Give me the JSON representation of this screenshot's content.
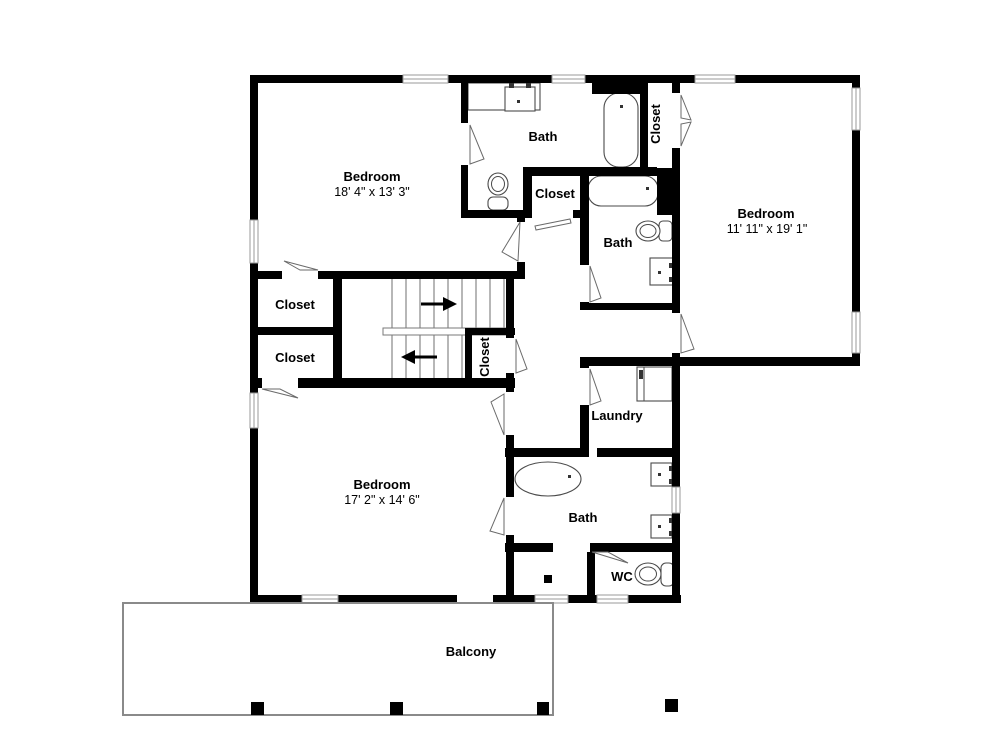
{
  "plan": {
    "title": "Upper floor plan",
    "rooms": {
      "bedroom_top_left": {
        "name": "Bedroom",
        "dims": "18' 4\" x 13' 3\""
      },
      "bath_top": {
        "name": "Bath"
      },
      "closet_hall": {
        "name": "Closet"
      },
      "closet_tub": {
        "name": "Closet"
      },
      "bedroom_right": {
        "name": "Bedroom",
        "dims": "11' 11\" x 19' 1\""
      },
      "bath_middle": {
        "name": "Bath"
      },
      "closet_left_upper": {
        "name": "Closet"
      },
      "closet_left_lower": {
        "name": "Closet"
      },
      "closet_stairs": {
        "name": "Closet"
      },
      "laundry": {
        "name": "Laundry"
      },
      "bedroom_bottom": {
        "name": "Bedroom",
        "dims": "17' 2\" x 14' 6\""
      },
      "bath_bottom": {
        "name": "Bath"
      },
      "wc": {
        "name": "WC"
      },
      "balcony": {
        "name": "Balcony"
      }
    },
    "icons": {
      "stairs_up_arrow": "arrow-right",
      "stairs_down_arrow": "arrow-left"
    },
    "colors": {
      "wall": "#000000",
      "fixture_line": "#4a4a4a",
      "window_line": "#9a9a9a",
      "balcony_line": "#8a8a8a"
    }
  }
}
